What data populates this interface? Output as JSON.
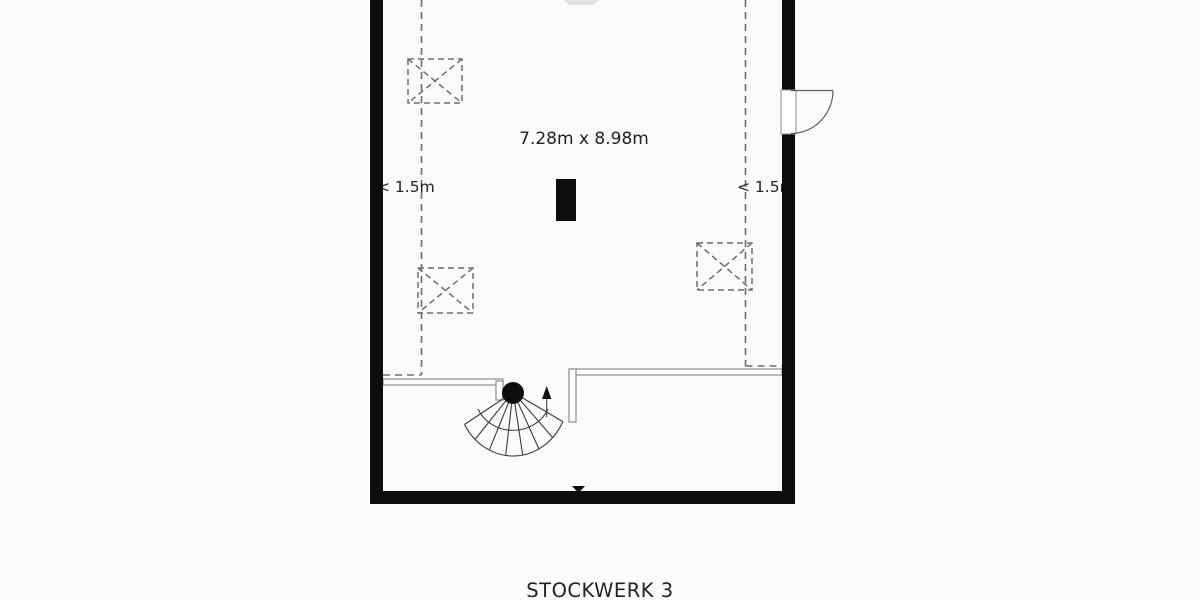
{
  "title": {
    "floor_label": "STOCKWERK 3"
  },
  "room": {
    "dimensions_label": "7.28m x 8.98m",
    "left_clearance_label": "< 1.5m",
    "right_clearance_label": "< 1.5m"
  },
  "legend": {
    "elements": [
      "exterior-walls",
      "roof-clearance-dashed-lines",
      "skylight",
      "skylight",
      "skylight",
      "chimney",
      "door",
      "winder-staircase"
    ]
  },
  "colors": {
    "background": "#fbfbfb",
    "wall": "#0d0d0d",
    "dashed_line": "#6e6e6e",
    "skylight_line": "#6e6e6e",
    "thin_wall": "#8c8c8c",
    "stair_line": "#3c3c3c",
    "door_line": "#5f5f5f",
    "text": "#222222",
    "faint_marker": "#e4e4e4"
  }
}
